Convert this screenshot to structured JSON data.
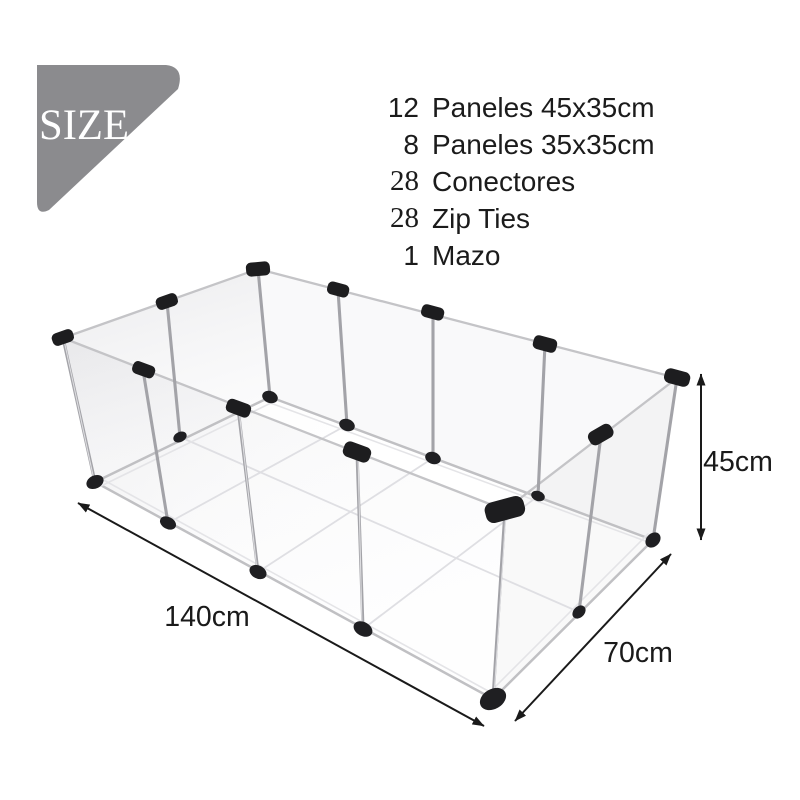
{
  "size_badge": {
    "label": "SIZE",
    "color": "#8b8b8e"
  },
  "parts_list": [
    {
      "qty": "12",
      "desc": "Paneles 45x35cm"
    },
    {
      "qty": "8",
      "desc": "Paneles 35x35cm"
    },
    {
      "qty": "28",
      "desc": "Conectores"
    },
    {
      "qty": "28",
      "desc": "Zip Ties"
    },
    {
      "qty": "1",
      "desc": "Mazo"
    }
  ],
  "dimensions": {
    "height": "45cm",
    "length": "140cm",
    "width": "70cm"
  },
  "colors": {
    "badge_gray": "#8b8b8e",
    "text": "#1b1b1b",
    "arrow_black": "#1a1a1a",
    "rail_silver": "#c4c4c7",
    "pole_silver": "#a3a3a8",
    "connector_black": "#1d1d1f"
  }
}
